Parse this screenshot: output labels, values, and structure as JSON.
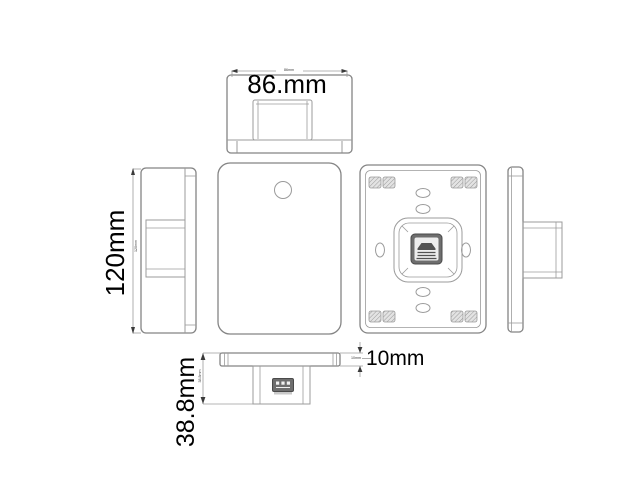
{
  "labels": {
    "width": {
      "big": "86.mm",
      "small": "86mm"
    },
    "height": {
      "big": "120mm",
      "small": "120mm"
    },
    "thickness": {
      "big": "10mm",
      "small": "10mm"
    },
    "depth": {
      "big": "38.8mm",
      "small": "38.8mm"
    }
  },
  "colors": {
    "background": "#ffffff",
    "line": "#9b9b9b",
    "line-dark": "#848484",
    "text": "#000000",
    "arrow": "#3a3a3a",
    "connector": "#6e6e6e",
    "connector-inner": "#ededed"
  }
}
